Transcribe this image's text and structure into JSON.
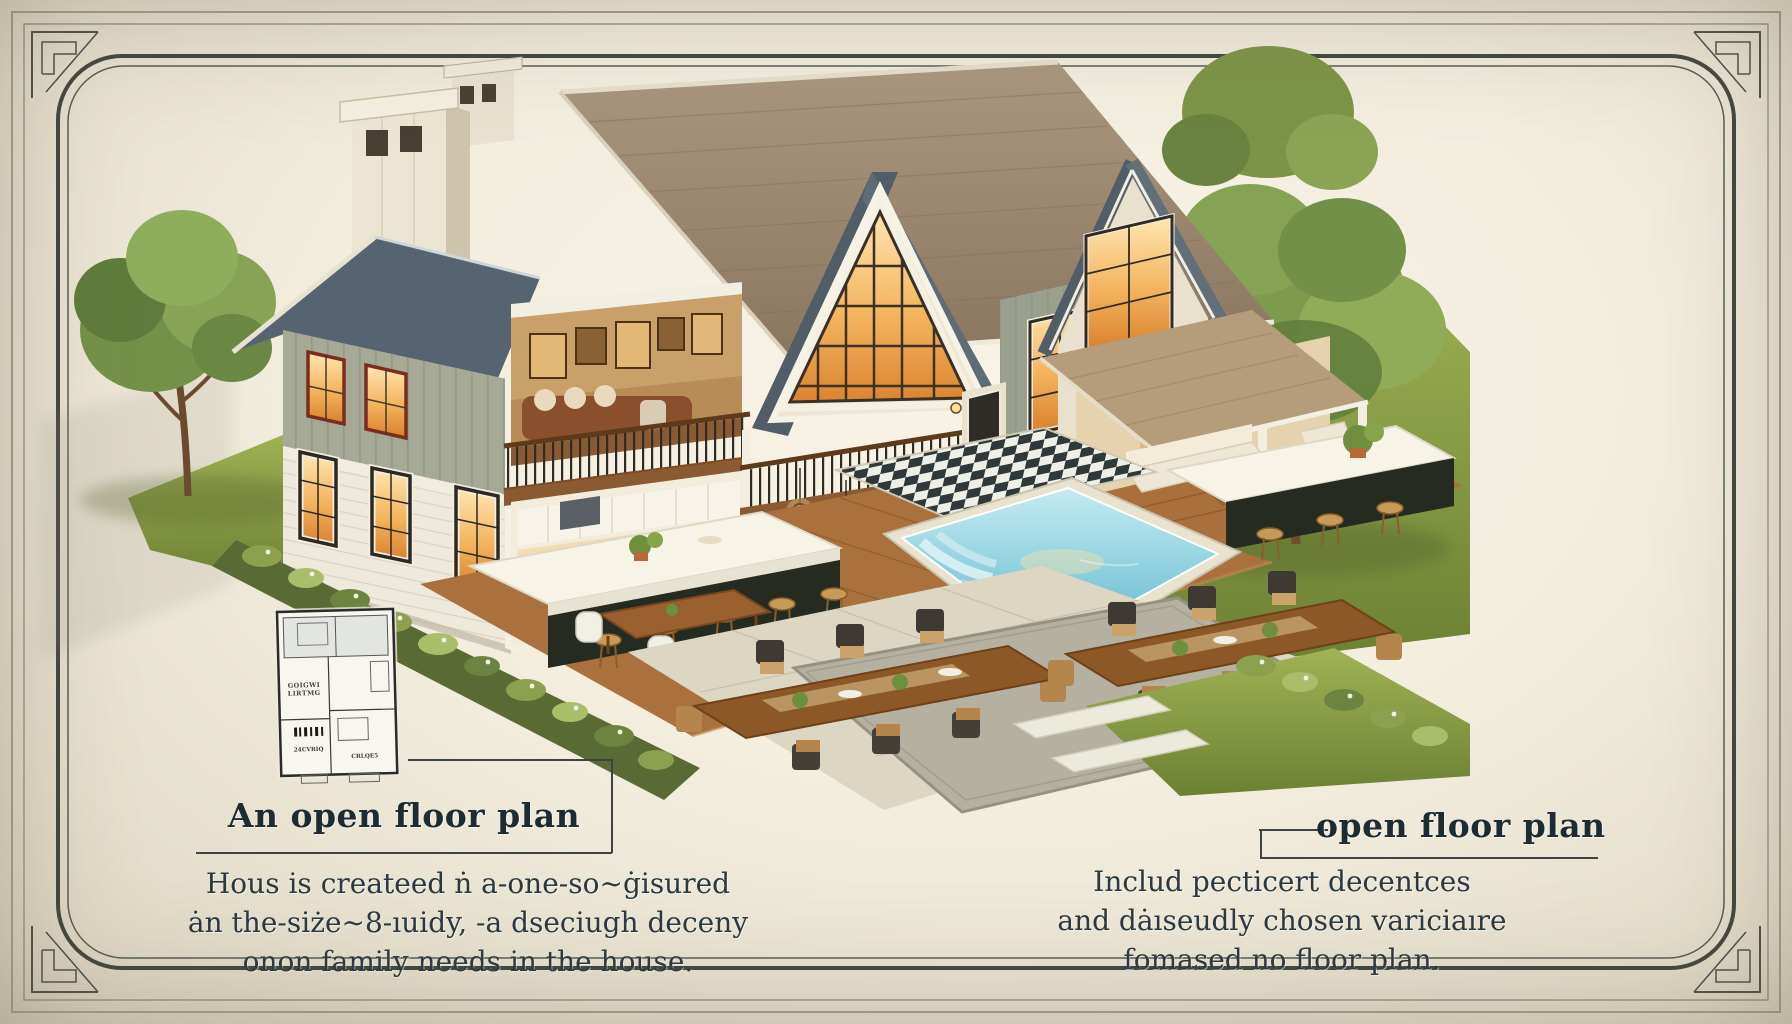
{
  "palette": {
    "background_cream": "#f3edde",
    "frame_line": "#40463f",
    "heading_text": "#1d2b33",
    "body_text": "#2b3940",
    "leader_line": "#3d4347",
    "roof_main_taupe": "#9c8870",
    "roof_slate": "#57636d",
    "siding_sage": "#a6a996",
    "siding_cream": "#efe9db",
    "window_glow": "#f3b35c",
    "grass_green": "#85974a",
    "pool_water": "#7cc4d6",
    "deck_wood": "#aa713e"
  },
  "callouts": {
    "left": {
      "heading": "An open floor plan",
      "lines": [
        "Hous is createed ṅ a-one-so~ġisured",
        "ȧn the-siże~8-ıuidy, -a dseciugh deceny",
        "onon family needs in the house."
      ]
    },
    "right": {
      "heading": "open floor plan",
      "lines": [
        "Includ pecticert decentces",
        "and dȧıseudly chosen variciaıre",
        "fomased no floor plan."
      ]
    }
  },
  "floor_plan_inset": {
    "labels": {
      "room_line1": "GOIGWI",
      "room_line2": "LIRTMG",
      "tag_left": "24CVRIQ",
      "tag_right": "CRLQE5"
    }
  }
}
